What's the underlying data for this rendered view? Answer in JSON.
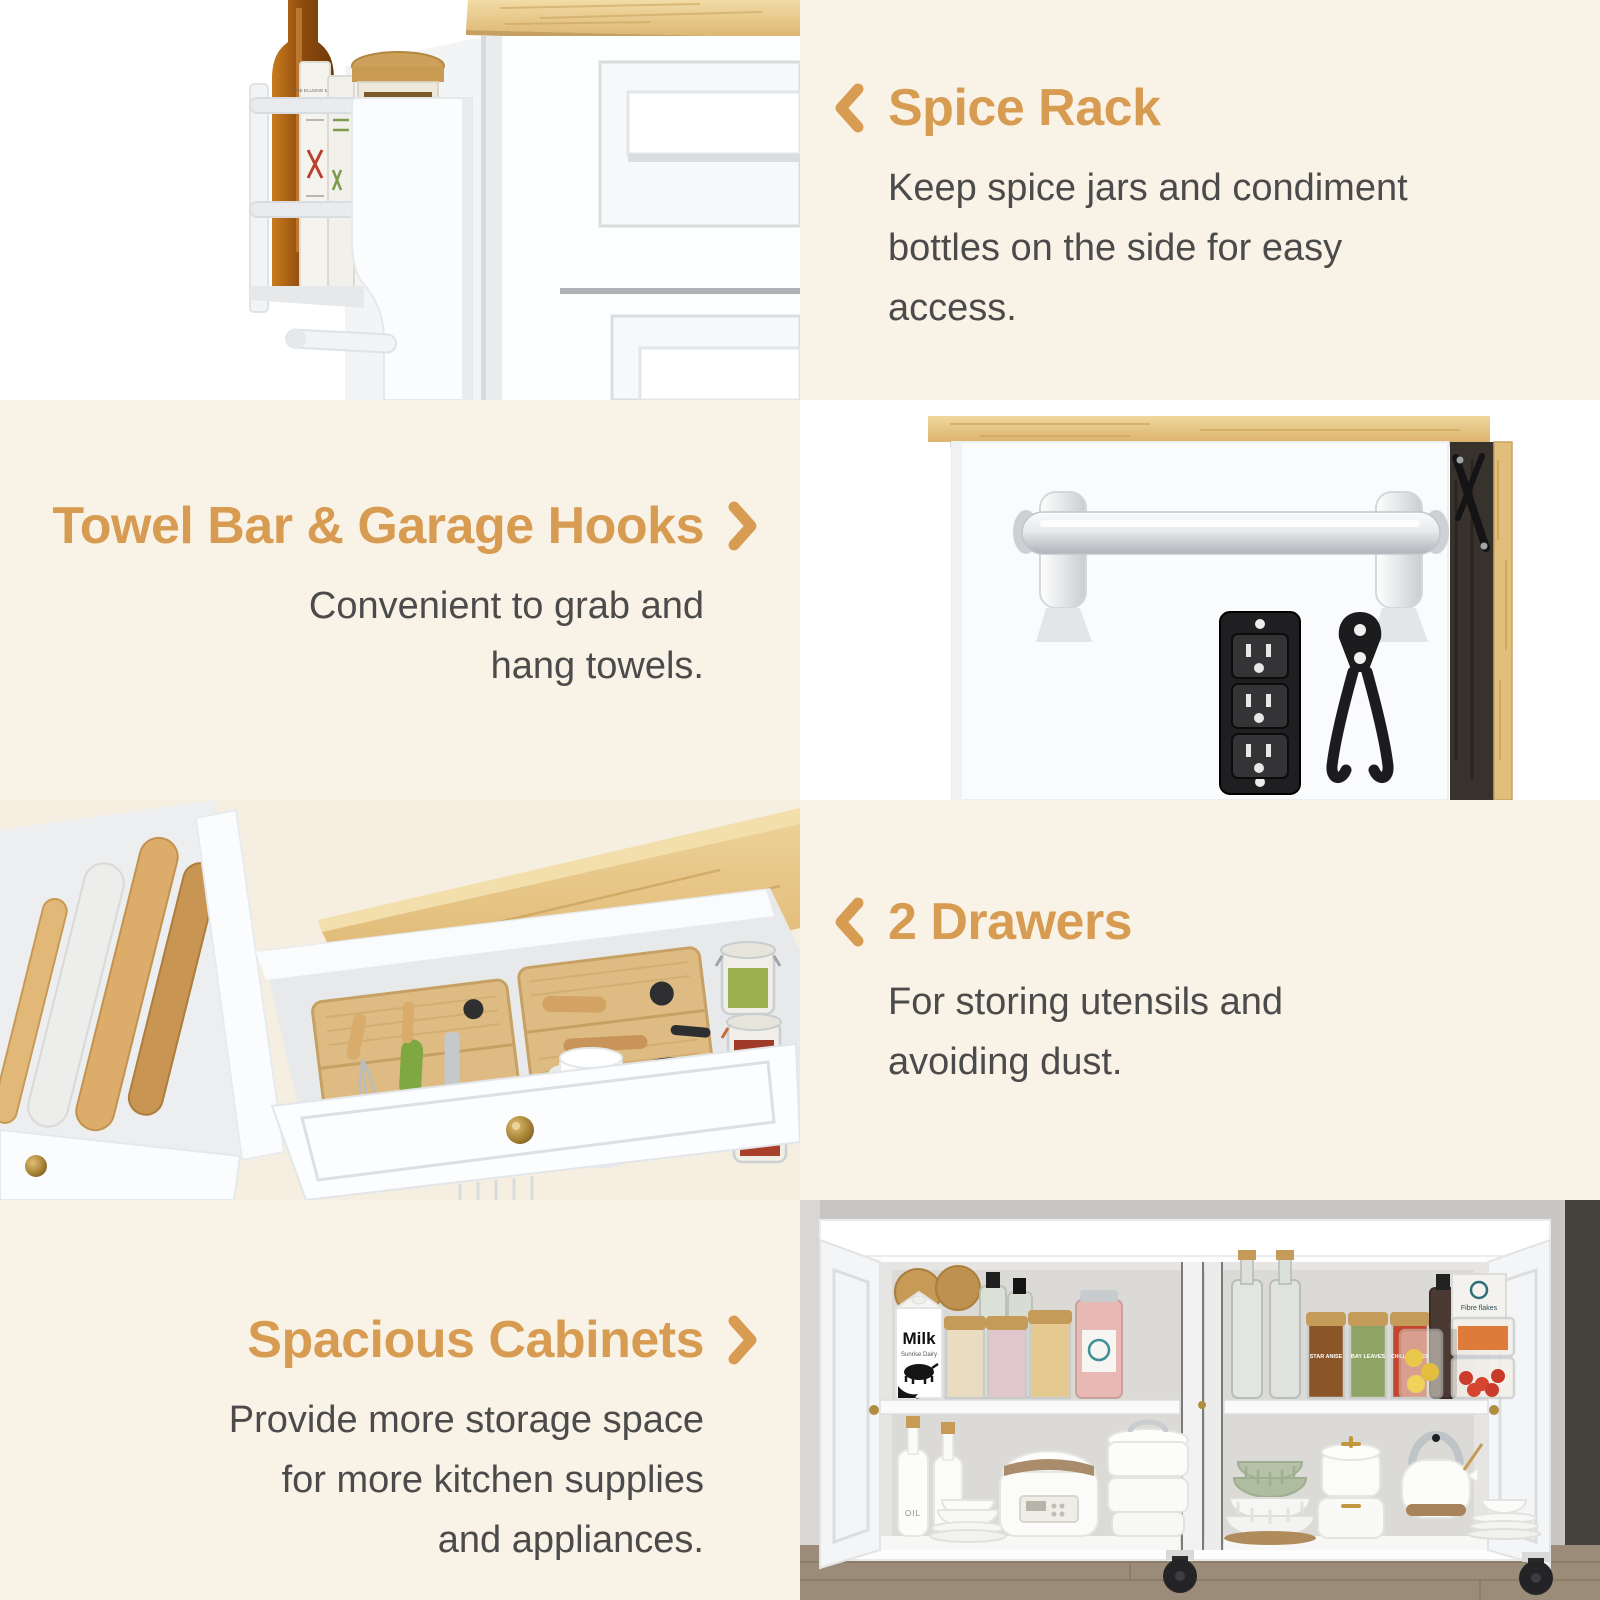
{
  "palette": {
    "background": "#F9F3E7",
    "accent": "#D79C52",
    "body_text": "#4B4B4B",
    "photo_background": "#FFFFFF",
    "wood": "#E7C282"
  },
  "sections": [
    {
      "id": "spice-rack",
      "title": "Spice Rack",
      "arrow": "left",
      "photo_side": "left",
      "description": "Keep spice jars and condiment bottles on the side for easy access.",
      "lines": [
        "Keep spice jars and condiment",
        "bottles on the side for easy",
        "access."
      ]
    },
    {
      "id": "towel-bar",
      "title": "Towel Bar & Garage Hooks",
      "arrow": "right",
      "photo_side": "right",
      "description": "Convenient to grab and hang towels.",
      "lines": [
        "Convenient to grab and",
        "hang towels."
      ]
    },
    {
      "id": "drawers",
      "title": "2 Drawers",
      "arrow": "left",
      "photo_side": "left",
      "description": "For storing utensils and avoiding dust.",
      "lines": [
        "For storing utensils and",
        "avoiding dust."
      ]
    },
    {
      "id": "cabinets",
      "title": "Spacious Cabinets",
      "arrow": "right",
      "photo_side": "right",
      "description": "Provide more storage space for more kitchen supplies and appliances.",
      "lines": [
        "Provide more storage space",
        "for more kitchen supplies",
        "and appliances."
      ]
    }
  ],
  "photo_labels": {
    "whisky_bottle": "THE ELUSIVE MALT",
    "milk_brand": "Milk",
    "milk_subtitle": "Sunrise Dairy",
    "spice_jar_1": "STAR ANISE",
    "spice_jar_2": "BAY LEAVES",
    "spice_jar_3": "CHILLI PEPPER",
    "cereal_box": "Fibre flakes",
    "oil_bottle": "OIL"
  }
}
